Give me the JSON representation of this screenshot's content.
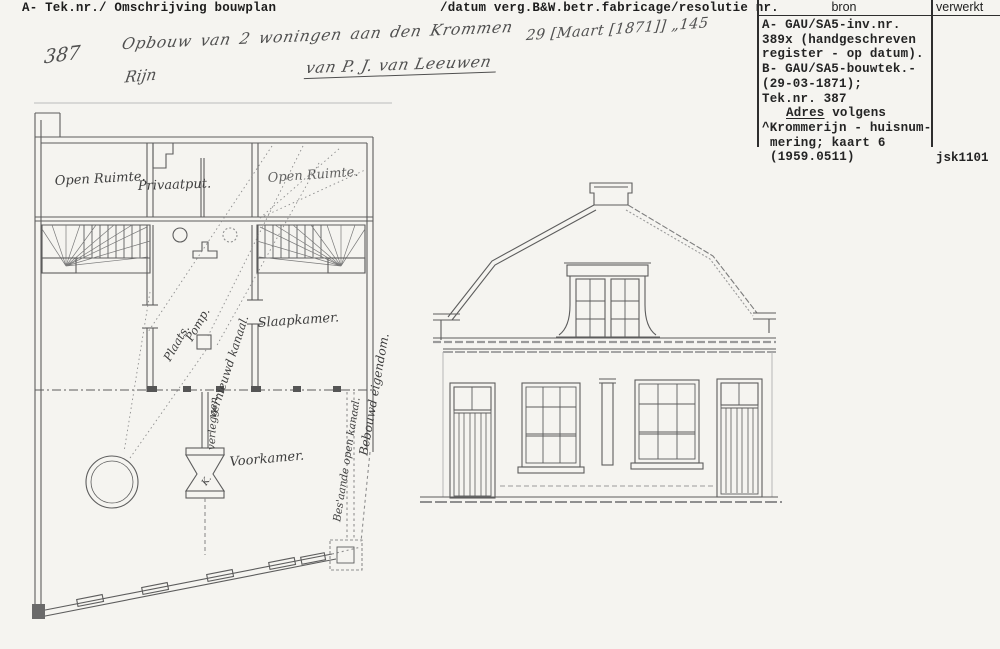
{
  "colors": {
    "paper": "#f5f4f0",
    "typed_ink": "#1d1d1d",
    "pencil_ink": "#4f4f4f",
    "drawing_line": "#5d5d5d"
  },
  "header": {
    "left": "A- Tek.nr./ Omschrijving bouwplan",
    "right": "/datum verg.B&W.betr.fabricage/resolutie nr."
  },
  "handwritten": {
    "tek_nr": "387",
    "description_line1": "Opbouw van 2 woningen aan den Krommen",
    "description_line2": "Rijn",
    "applicant": "van P. J. van Leeuwen",
    "date_resolution": "29 [Maart [1871]] „145"
  },
  "bron_table": {
    "header_bron": "bron",
    "header_verwerkt": "verwerkt",
    "lines_a": [
      "A- GAU/SA5-inv.nr.",
      "389x (handgeschreven",
      "register - op datum).",
      "B- GAU/SA5-bouwtek.-",
      "(29-03-1871);",
      "Tek.nr. 387"
    ],
    "adres_label": "Adres",
    "adres_rest": " volgens",
    "lines_b": [
      "^Krommerijn - huisnum-",
      "mering; kaart 6",
      "(1959.0511)"
    ],
    "code": "jsk1101"
  },
  "floorplan": {
    "labels": {
      "open_ruimte_left": "Open Ruimte.",
      "privaatput": "Privaatput.",
      "open_ruimte_right": "Open Ruimte.",
      "slaapkamer": "Slaapkamer.",
      "plaats": "Plaats.",
      "pomp": "Pomp.",
      "kanaal": "vernieuwd kanaal.",
      "verleggen": "verleggen.",
      "k_mark": "K.",
      "voorkamer": "Voorkamer.",
      "bestaande_kanaal": "Bes'aande open kanaal.",
      "bebouwd": "Bebouwd eigendom."
    }
  }
}
